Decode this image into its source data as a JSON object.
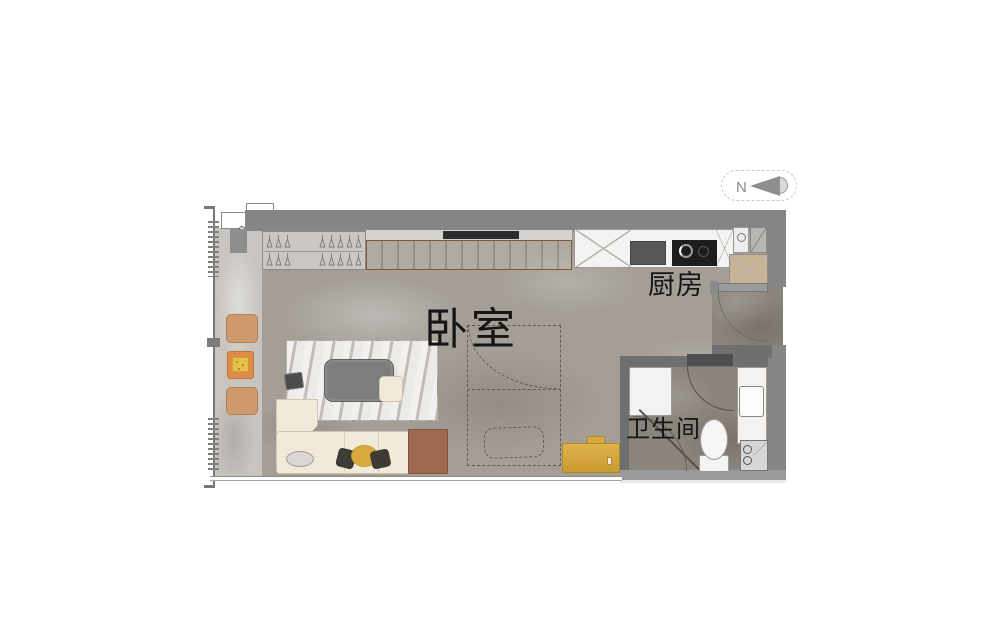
{
  "compass": {
    "label": "N"
  },
  "rooms": {
    "bedroom": {
      "label": "卧室"
    },
    "kitchen": {
      "label": "厨房"
    },
    "bathroom": {
      "label": "卫生间"
    }
  },
  "wardrobe": {
    "hanger_groups": [
      [
        3,
        5
      ],
      [
        3,
        5
      ]
    ]
  },
  "furniture_icons": [
    "wardrobe",
    "tv-panel",
    "kitchen-counter",
    "cooktop",
    "sink",
    "fridge",
    "entry-door",
    "murphy-bed",
    "sofa",
    "coffee-table",
    "rug",
    "side-cabinet",
    "gold-desk",
    "shower",
    "toilet",
    "vanity",
    "washing-machine",
    "pouf",
    "side-table"
  ],
  "colors": {
    "wall": "#858585",
    "bathroom_wall": "#6f6f6f",
    "bedroom_floor": "#a49e97",
    "balcony_floor": "#c8c5c0",
    "bathroom_floor": "#8b847d",
    "wood_panel": "#b5854f",
    "accent_orange": "#df8b4a",
    "accent_gold": "#d9a93f",
    "sofa_cream": "#f2ead9",
    "pouf_tan": "#cf9a6e",
    "label_text": "#151515"
  }
}
